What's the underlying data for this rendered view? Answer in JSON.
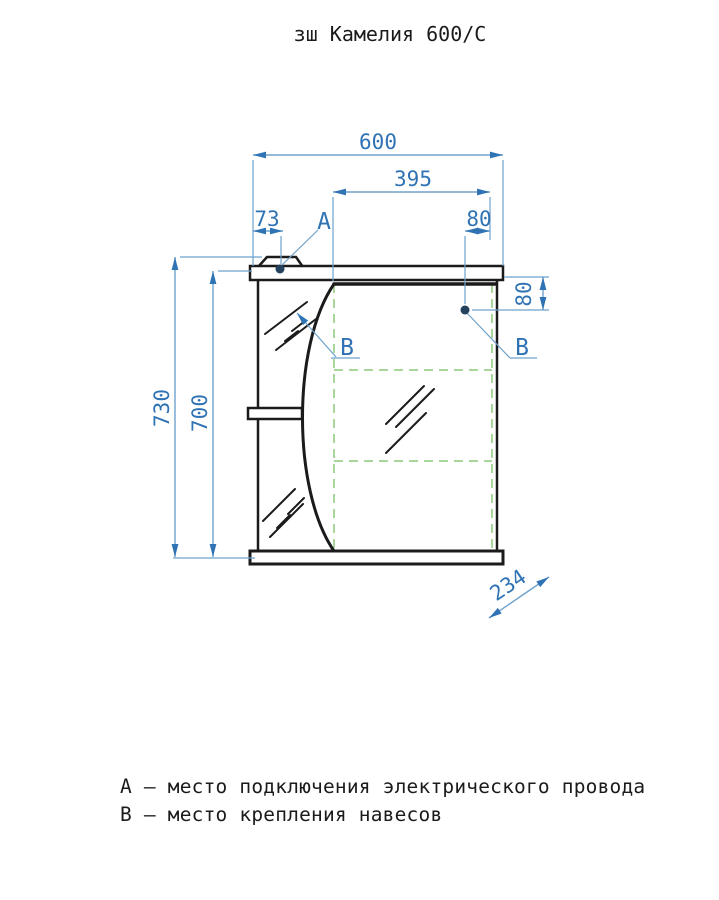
{
  "title": "зш Камелия 600/С",
  "dimensions": {
    "overall_width": "600",
    "door_width": "395",
    "left_offset": "73",
    "top_right_offset": "80",
    "side_offset": "80",
    "overall_height": "730",
    "body_height": "700",
    "depth": "234"
  },
  "labels": {
    "point_a": "А",
    "point_b": "В"
  },
  "legend": {
    "line_a": "А – место подключения электрического провода",
    "line_b": "В – место крепления навесов"
  },
  "colors": {
    "dimension_line": "#6ea2cc",
    "dimension_text": "#2f73b4",
    "outline": "#1b1b1b",
    "door_dashed": "#a9d69b",
    "mount_point": "#24425e",
    "background": "#ffffff"
  }
}
